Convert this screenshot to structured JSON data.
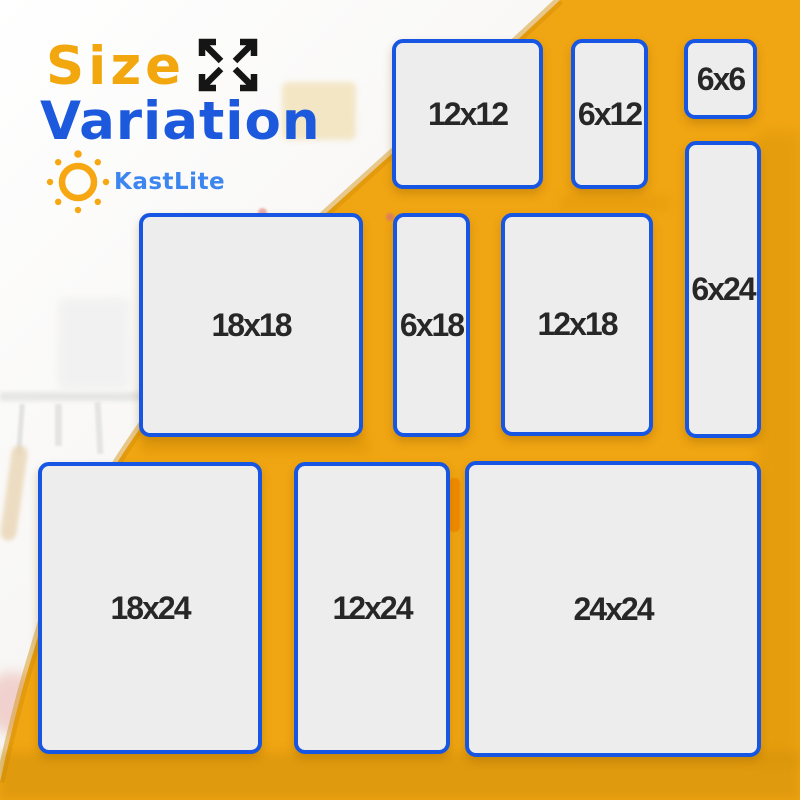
{
  "header": {
    "title_accent": "Size",
    "title_main": "Variation"
  },
  "brand": {
    "name": "KastLite"
  },
  "icons": {
    "expand": "expand-arrows-icon",
    "sun": "sun-logo-icon"
  },
  "colors": {
    "title_orange": "#f2a70f",
    "title_blue": "#1c59dc",
    "brand_blue": "#3e86ef",
    "overlay_yellow": "#f0a512",
    "panel_border_blue": "#1656e2",
    "panel_fill_gray": "#ededed",
    "label_text": "#272727"
  },
  "panels": [
    {
      "label": "12x12",
      "rect": {
        "x": 392,
        "y": 39,
        "w": 151,
        "h": 150
      }
    },
    {
      "label": "6x12",
      "rect": {
        "x": 571,
        "y": 39,
        "w": 77,
        "h": 150
      }
    },
    {
      "label": "6x6",
      "rect": {
        "x": 684,
        "y": 39,
        "w": 73,
        "h": 80
      }
    },
    {
      "label": "6x24",
      "rect": {
        "x": 685,
        "y": 141,
        "w": 76,
        "h": 297
      }
    },
    {
      "label": "18x18",
      "rect": {
        "x": 139,
        "y": 213,
        "w": 224,
        "h": 224
      }
    },
    {
      "label": "6x18",
      "rect": {
        "x": 393,
        "y": 213,
        "w": 77,
        "h": 224
      }
    },
    {
      "label": "12x18",
      "rect": {
        "x": 501,
        "y": 213,
        "w": 152,
        "h": 223
      }
    },
    {
      "label": "18x24",
      "rect": {
        "x": 38,
        "y": 462,
        "w": 224,
        "h": 292
      }
    },
    {
      "label": "12x24",
      "rect": {
        "x": 294,
        "y": 462,
        "w": 156,
        "h": 292
      }
    },
    {
      "label": "24x24",
      "rect": {
        "x": 465,
        "y": 461,
        "w": 296,
        "h": 296
      }
    }
  ]
}
